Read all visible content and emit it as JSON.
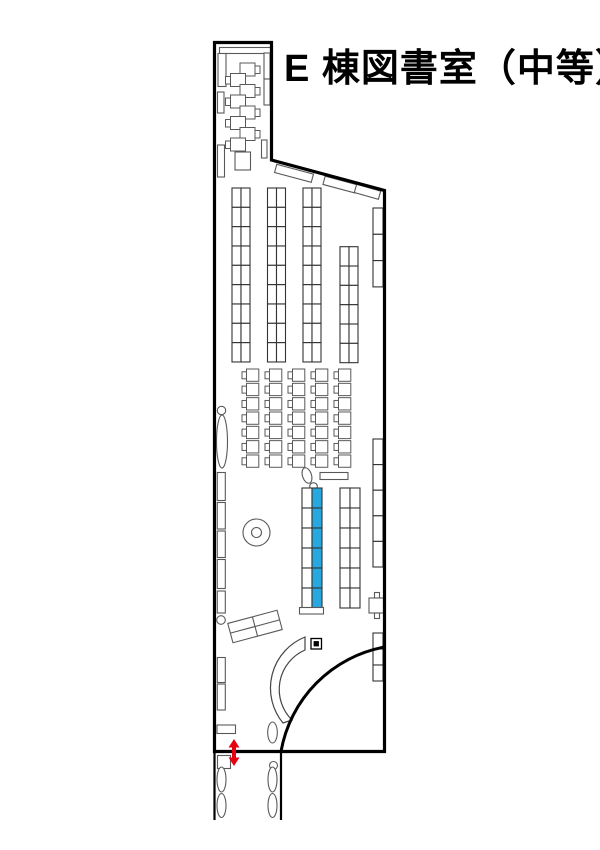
{
  "title": {
    "text": "E 棟図書室（中等）"
  },
  "colors": {
    "background": "#ffffff",
    "wall": "#000000",
    "line": "#595959",
    "shelf_line": "#333333",
    "highlight": "#29a7df",
    "accent_red": "#e60012"
  },
  "walls": {
    "room_outline": "M 214.5,42.5 H 271.5 V 160 L 384.5,190.5 V 751.5 H 214.5 Z",
    "curved_partition": "M 384.5,647 A 129,129 0 0 0 281,751.5",
    "corridor": "M 214.5,751.5 V 820 M 281,751.5 V 820"
  },
  "entrance_arrow": {
    "shape": "M234,739 L239.5,747.5 L236,747.5 L236,757.5 L239.5,757.5 L234,766 L228.5,757.5 L232,757.5 L232,747.5 L228.5,747.5 Z"
  },
  "furniture": [
    {
      "name": "top-wall-shelf",
      "type": "rect",
      "x": 219.5,
      "y": 47.5,
      "w": 51,
      "h": 6
    },
    {
      "name": "top-left-cabinet",
      "type": "rect",
      "x": 218,
      "y": 53.5,
      "w": 8,
      "h": 33
    },
    {
      "name": "left-window-1",
      "type": "rect",
      "x": 217.5,
      "y": 92,
      "w": 6.5,
      "h": 21
    },
    {
      "name": "right-wall-shelf-top-room",
      "type": "cellgrid",
      "x": 264,
      "y": 53,
      "cols": 1,
      "rows": 2,
      "cw": 6,
      "ch": 26
    },
    {
      "name": "right-wall-shelf-top-room-2",
      "type": "rect",
      "x": 261.5,
      "y": 140,
      "w": 5.5,
      "h": 18
    },
    {
      "name": "carrel-desk",
      "type": "desk",
      "x": 240,
      "y": 63,
      "side": "right"
    },
    {
      "name": "carrel-desk",
      "type": "desk",
      "x": 230.5,
      "y": 73.5,
      "side": "left"
    },
    {
      "name": "carrel-desk",
      "type": "desk",
      "x": 240,
      "y": 84.5,
      "side": "right"
    },
    {
      "name": "carrel-desk",
      "type": "desk",
      "x": 230.5,
      "y": 95,
      "side": "left"
    },
    {
      "name": "carrel-desk",
      "type": "desk",
      "x": 240,
      "y": 106,
      "side": "right"
    },
    {
      "name": "carrel-desk",
      "type": "desk",
      "x": 230.5,
      "y": 116.5,
      "side": "left"
    },
    {
      "name": "carrel-desk",
      "type": "desk",
      "x": 240,
      "y": 127.5,
      "side": "right"
    },
    {
      "name": "carrel-desk",
      "type": "desk",
      "x": 230.5,
      "y": 138,
      "side": "left"
    },
    {
      "name": "left-window-2",
      "type": "rect",
      "x": 217.5,
      "y": 145,
      "w": 7,
      "h": 32
    },
    {
      "name": "small-table",
      "type": "rect",
      "x": 235,
      "y": 152,
      "w": 15.5,
      "h": 18
    },
    {
      "name": "diagonal-wall-shelf-1",
      "type": "rotrect",
      "cx": 294,
      "cy": 173.3,
      "w": 38,
      "h": 8.5,
      "angle": 15
    },
    {
      "name": "diagonal-wall-shelf-2",
      "type": "rotrect",
      "cx": 340,
      "cy": 184.6,
      "w": 33,
      "h": 8.5,
      "angle": 15
    },
    {
      "name": "diagonal-wall-shelf-3",
      "type": "rotrect",
      "cx": 367.5,
      "cy": 191.8,
      "w": 25,
      "h": 8.5,
      "angle": 16
    },
    {
      "name": "bookshelf-column-1",
      "type": "cellgrid",
      "x": 232,
      "y": 188,
      "cols": 2,
      "rows": 9,
      "cw": 9,
      "ch": 19.33,
      "stroke": "#333333"
    },
    {
      "name": "bookshelf-column-2",
      "type": "cellgrid",
      "x": 267.5,
      "y": 188,
      "cols": 2,
      "rows": 9,
      "cw": 9,
      "ch": 19.33,
      "stroke": "#333333"
    },
    {
      "name": "bookshelf-column-3",
      "type": "cellgrid",
      "x": 303,
      "y": 188,
      "cols": 2,
      "rows": 9,
      "cw": 9,
      "ch": 19.33,
      "stroke": "#333333"
    },
    {
      "name": "bookshelf-column-4",
      "type": "cellgrid",
      "x": 340,
      "y": 246.7,
      "cols": 2,
      "rows": 6,
      "cw": 9,
      "ch": 19.33,
      "stroke": "#333333"
    },
    {
      "name": "right-wall-shelf-a",
      "type": "cellgrid",
      "x": 373,
      "y": 208,
      "cols": 1,
      "rows": 3,
      "cw": 10,
      "ch": 26.3,
      "stroke": "#333333"
    },
    {
      "name": "reading-desk-grid",
      "type": "deskgrid",
      "x0": 242,
      "y0": 369,
      "dx": 23,
      "dy": 14.33,
      "cols": 5,
      "rows": 7
    },
    {
      "name": "planter-oval-left",
      "type": "ellipse",
      "cx": 222,
      "cy": 441.5,
      "rx": 5.5,
      "ry": 26.5
    },
    {
      "name": "planter-knob-left",
      "type": "circle",
      "cx": 221.5,
      "cy": 410.5,
      "r": 4.2
    },
    {
      "name": "left-window-3",
      "type": "rect",
      "x": 217.3,
      "y": 472.5,
      "w": 8,
      "h": 28
    },
    {
      "name": "left-window-4",
      "type": "rect",
      "x": 217.3,
      "y": 502.5,
      "w": 8,
      "h": 26.5
    },
    {
      "name": "left-window-5",
      "type": "rect",
      "x": 217.3,
      "y": 531,
      "w": 8,
      "h": 26.5
    },
    {
      "name": "left-window-6",
      "type": "rect",
      "x": 217.3,
      "y": 559.5,
      "w": 8,
      "h": 29
    },
    {
      "name": "left-window-7",
      "type": "rect",
      "x": 217.3,
      "y": 591,
      "w": 8,
      "h": 22
    },
    {
      "name": "wall-knob",
      "type": "circle",
      "cx": 221,
      "cy": 620,
      "r": 4.3
    },
    {
      "name": "left-window-8",
      "type": "rect",
      "x": 217.3,
      "y": 657.5,
      "w": 8,
      "h": 25
    },
    {
      "name": "left-window-9",
      "type": "rect",
      "x": 217.3,
      "y": 684,
      "w": 8,
      "h": 26
    },
    {
      "name": "round-table",
      "type": "circle",
      "cx": 256.5,
      "cy": 532.5,
      "r": 13.5
    },
    {
      "name": "round-table-center",
      "type": "circle",
      "cx": 256.5,
      "cy": 532.5,
      "r": 5
    },
    {
      "name": "small-oval-center",
      "type": "ellipse",
      "cx": 307,
      "cy": 475.5,
      "rx": 4.5,
      "ry": 8,
      "angle": -18
    },
    {
      "name": "small-knob-center",
      "type": "circle",
      "cx": 313.5,
      "cy": 486.5,
      "r": 3.8
    },
    {
      "name": "counter-bar",
      "type": "rect",
      "x": 320,
      "y": 472.5,
      "w": 28,
      "h": 7
    },
    {
      "name": "highlighted-shelf-white-column",
      "type": "cellgrid",
      "x": 302,
      "y": 488,
      "cols": 1,
      "rows": 6,
      "cw": 10,
      "ch": 20,
      "stroke": "#333333"
    },
    {
      "name": "highlighted-shelf-blue-column",
      "type": "cellgrid",
      "x": 312,
      "y": 488,
      "cols": 1,
      "rows": 6,
      "cw": 10,
      "ch": 20,
      "stroke": "#333333",
      "fill": "highlight"
    },
    {
      "name": "highlighted-shelf-base",
      "type": "rect",
      "x": 299.5,
      "y": 607.5,
      "w": 24,
      "h": 6.5
    },
    {
      "name": "center-shelf",
      "type": "cellgrid",
      "x": 340,
      "y": 488,
      "cols": 2,
      "rows": 6,
      "cw": 10,
      "ch": 20,
      "stroke": "#333333"
    },
    {
      "name": "right-wall-shelf-b",
      "type": "cellgrid",
      "x": 373,
      "y": 439,
      "cols": 1,
      "rows": 5,
      "cw": 10,
      "ch": 25.6,
      "stroke": "#333333"
    },
    {
      "name": "book-trolley-wheel-top",
      "type": "rect",
      "x": 374.5,
      "y": 592.5,
      "w": 5,
      "h": 5.5
    },
    {
      "name": "book-trolley-body",
      "type": "rect",
      "x": 369,
      "y": 598,
      "w": 14.5,
      "h": 15
    },
    {
      "name": "book-trolley-wheel-bottom",
      "type": "rect",
      "x": 374.5,
      "y": 613,
      "w": 5,
      "h": 5.5
    },
    {
      "name": "right-wall-shelf-c",
      "type": "cellgrid",
      "x": 373,
      "y": 633,
      "cols": 1,
      "rows": 3,
      "cw": 10,
      "ch": 16,
      "stroke": "#333333"
    },
    {
      "name": "angled-counter-desk",
      "type": "rotrect",
      "cx": 255,
      "cy": 626.5,
      "w": 51,
      "h": 20,
      "angle": -15,
      "divV": true,
      "divH": true
    },
    {
      "name": "curved-counter",
      "type": "path",
      "d": "M305,637 A55,55 0 0 0 283,723 L292,720 A43,43 0 0 1 305,650 Z",
      "fill": "#ffffff",
      "stroke": "#444444",
      "sw": 1.2
    },
    {
      "name": "gate-marker-outer",
      "type": "rect",
      "x": 311,
      "y": 638.5,
      "w": 10.5,
      "h": 10.5,
      "stroke": "#000000",
      "sw": 1.3
    },
    {
      "name": "gate-marker-inner",
      "type": "rect",
      "x": 313.6,
      "y": 641.1,
      "w": 5.3,
      "h": 5.3,
      "fill": "#000000",
      "stroke": "none"
    },
    {
      "name": "planter-oval-entrance",
      "type": "ellipse",
      "cx": 272.5,
      "cy": 732.5,
      "rx": 4.8,
      "ry": 10.5
    },
    {
      "name": "planter-knob-entrance",
      "type": "circle",
      "cx": 273.5,
      "cy": 765.5,
      "r": 4
    },
    {
      "name": "entrance-mat",
      "type": "rect",
      "x": 217,
      "y": 725,
      "w": 18.5,
      "h": 8.5
    },
    {
      "name": "corridor-box",
      "type": "rect",
      "x": 217.5,
      "y": 755.5,
      "w": 13,
      "h": 13
    },
    {
      "name": "corridor-planter",
      "type": "ellipse",
      "cx": 221.5,
      "cy": 779.5,
      "rx": 4.5,
      "ry": 12.5
    },
    {
      "name": "corridor-planter",
      "type": "ellipse",
      "cx": 221.5,
      "cy": 805.5,
      "rx": 4.5,
      "ry": 12
    },
    {
      "name": "corridor-planter",
      "type": "ellipse",
      "cx": 272.5,
      "cy": 779.5,
      "rx": 4.5,
      "ry": 12.5
    },
    {
      "name": "corridor-planter",
      "type": "ellipse",
      "cx": 272.5,
      "cy": 805.5,
      "rx": 4.5,
      "ry": 12
    }
  ]
}
